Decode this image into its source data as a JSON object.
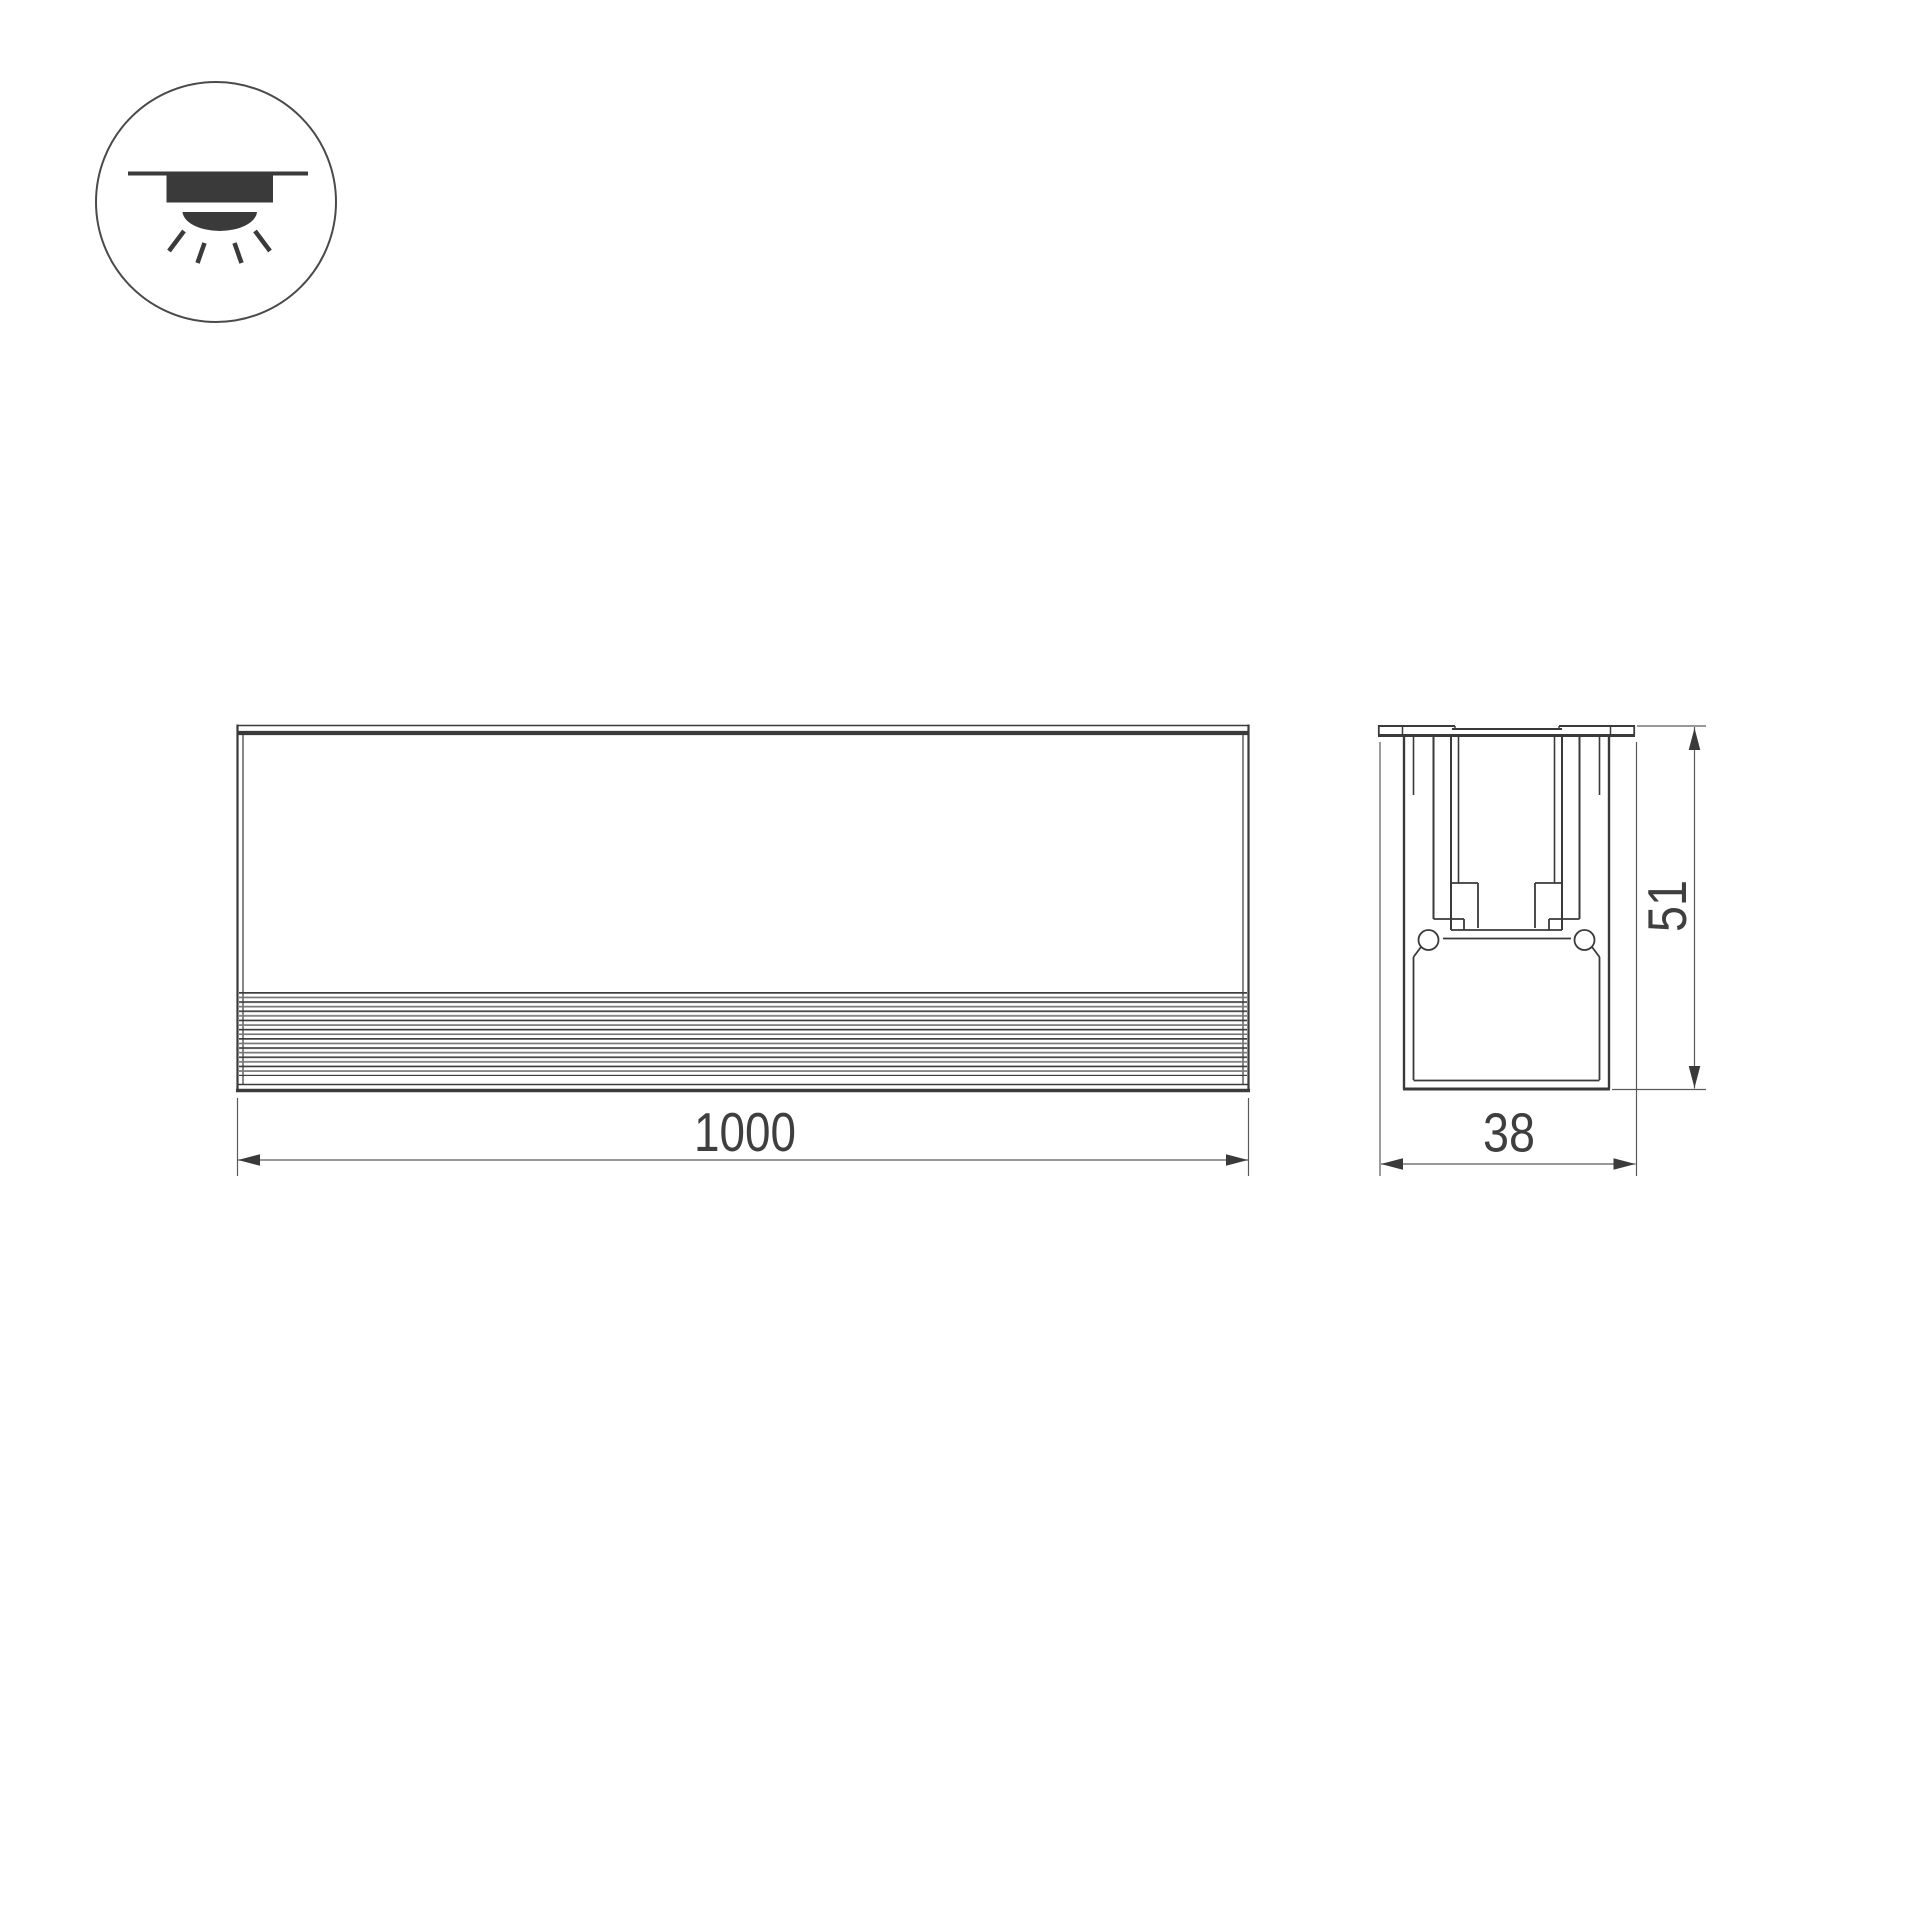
{
  "icon": {
    "name": "recessed-downlight-icon",
    "description": "recessed ceiling luminaire emitting light downward"
  },
  "front_view": {
    "width_dimension": {
      "value": "1000"
    }
  },
  "section_view": {
    "width_dimension": {
      "value": "38"
    },
    "height_dimension": {
      "value": "51"
    }
  },
  "colors": {
    "background": "#ffffff",
    "line": "#3a3a3a",
    "dim_line": "#5a5a5a",
    "text": "#3f3f3f",
    "icon_fill": "#3a3a3a",
    "rib_dark": "#3e3e3e",
    "rib_light": "#787878"
  }
}
